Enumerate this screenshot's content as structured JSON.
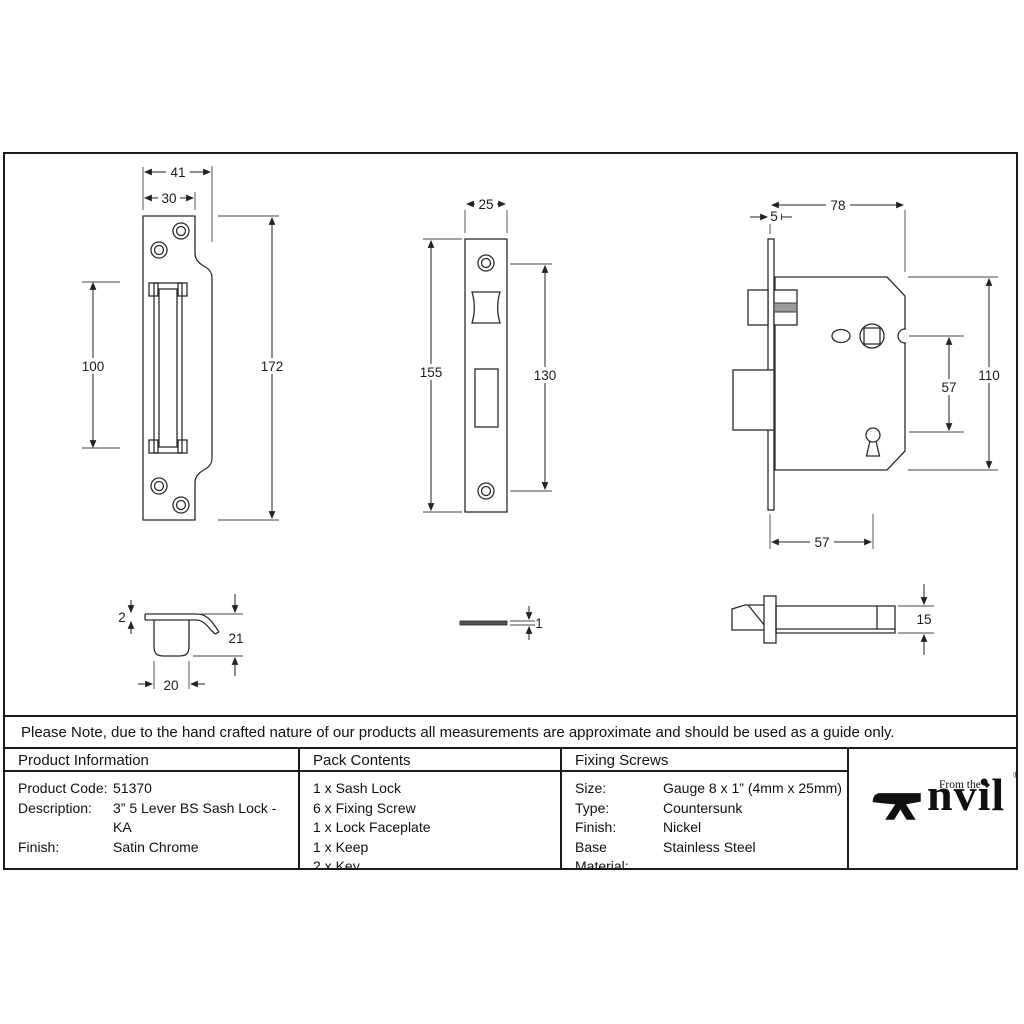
{
  "sheet": {
    "note": "Please Note, due to the hand crafted nature of our products all measurements are approximate and should be used as a guide only."
  },
  "dimensions": {
    "keep_front": {
      "outer_width": "41",
      "inner_width": "30",
      "opening_height": "100",
      "plate_height": "172"
    },
    "faceplate_front": {
      "width": "25",
      "plate_height": "155",
      "screw_spacing": "130"
    },
    "lock_side": {
      "body_width": "78",
      "faceplate_thickness": "5",
      "body_height": "110",
      "spindle_to_keyhole": "57",
      "backset": "57"
    },
    "keep_side": {
      "plate_thickness": "2",
      "depth": "21",
      "box_width": "20"
    },
    "faceplate_side": {
      "thickness": "1"
    },
    "lock_top": {
      "case_thickness": "15"
    }
  },
  "table": {
    "product_information": {
      "header": "Product Information",
      "rows": [
        {
          "label": "Product Code:",
          "value": "51370"
        },
        {
          "label": "Description:",
          "value": "3” 5 Lever BS Sash Lock - KA"
        },
        {
          "label": "Finish:",
          "value": "Satin Chrome"
        }
      ]
    },
    "pack_contents": {
      "header": "Pack Contents",
      "items": [
        "1 x Sash Lock",
        "6 x Fixing Screw",
        "1 x Lock Faceplate",
        "1 x Keep",
        "2 x Key"
      ]
    },
    "fixing_screws": {
      "header": "Fixing Screws",
      "rows": [
        {
          "label": "Size:",
          "value": "Gauge 8 x 1” (4mm x 25mm)"
        },
        {
          "label": "Type:",
          "value": "Countersunk"
        },
        {
          "label": "Finish:",
          "value": "Nickel"
        },
        {
          "label": "Base Material:",
          "value": "Stainless Steel"
        }
      ]
    }
  },
  "logo": {
    "prefix": "From the",
    "diamond": "◆",
    "name_rest": "nvil",
    "registered": "®"
  }
}
